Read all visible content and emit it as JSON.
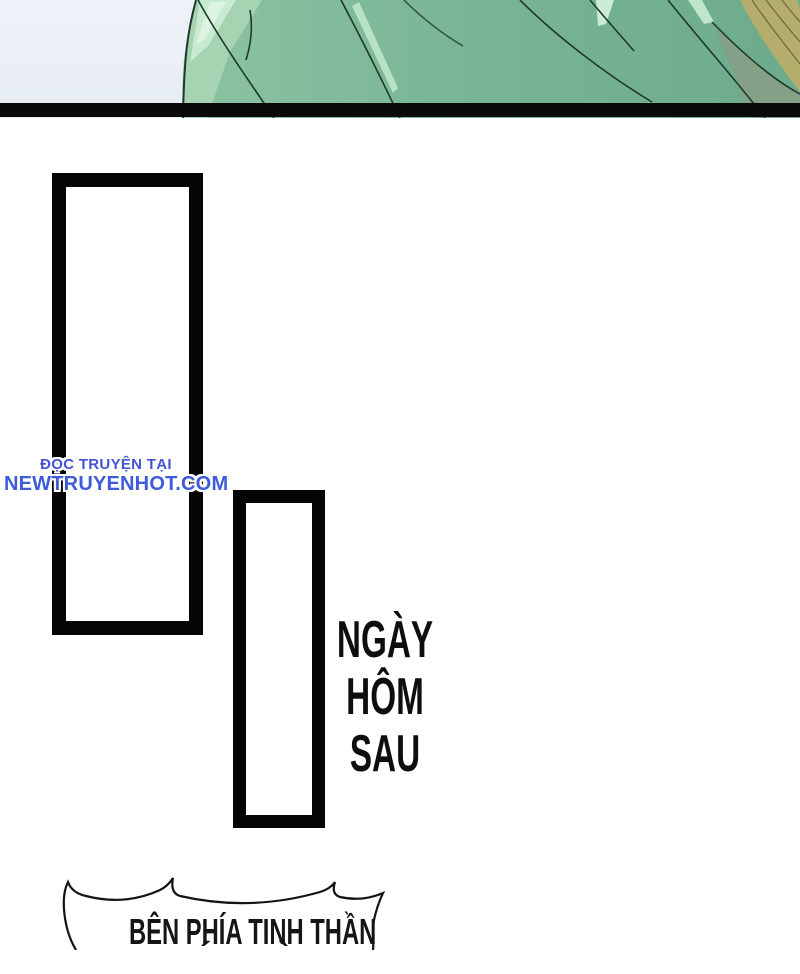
{
  "page": {
    "background": "#ffffff"
  },
  "top_panel": {
    "sky_color": "#eef2f8",
    "sky_color_bottom": "#e7edf4",
    "garment_green_left": "#8cc3a2",
    "garment_green_right": "#6cab8b",
    "garment_light": "#a6d4b3",
    "garment_highlight": "#c7ead0",
    "garment_highlight_bright": "#ddf4e2",
    "tan_band": "#b5ad6c",
    "tan_strand": "#6e6a3a",
    "shade_green": "#8b9c85",
    "fold_line_color": "#1f3a2b",
    "divider_color": "#0a0a0a"
  },
  "panels": {
    "frame_color": "#050505",
    "fill": "#ffffff"
  },
  "watermark": {
    "line1": "ĐỌC TRUYỆN TẠI",
    "line2": "NEWTRUYENHOT.COM",
    "text_color": "#3e5bd9",
    "outline_color": "#ffffff"
  },
  "caption": {
    "lines": [
      "NGÀY",
      "HÔM",
      "SAU"
    ],
    "color": "#0e0e0e"
  },
  "speech_bubble": {
    "line1": "BÊN PHÍA TINH THẦN",
    "line2_fragments": [
      "´",
      "`"
    ],
    "outline_color": "#141414",
    "fill": "#ffffff",
    "text_color": "#151515"
  }
}
